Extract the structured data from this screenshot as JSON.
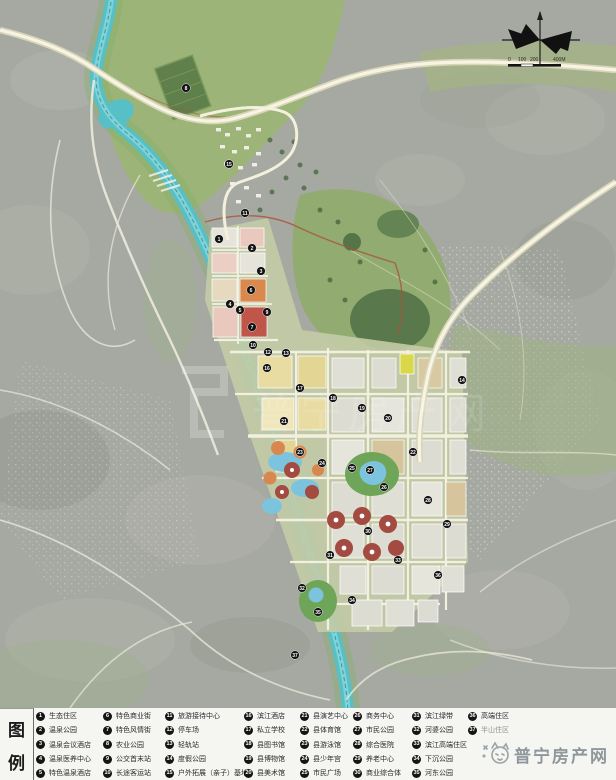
{
  "map": {
    "scale_bar": {
      "labels": [
        "0",
        "100",
        "200",
        "400M"
      ],
      "label_x": [
        0,
        10,
        22,
        45
      ]
    },
    "ghost_watermark": "普宁房产网",
    "colors": {
      "river": "#57bfc6",
      "marker": "#141414",
      "terrain": "#a6a9a1",
      "green": "#96ad74",
      "legend_bg": "#f5f5f2",
      "watermark_gray": "#8e979c"
    },
    "markers": [
      {
        "n": 1,
        "x": 219,
        "y": 239
      },
      {
        "n": 2,
        "x": 252,
        "y": 248
      },
      {
        "n": 3,
        "x": 261,
        "y": 271
      },
      {
        "n": 4,
        "x": 230,
        "y": 304
      },
      {
        "n": 5,
        "x": 240,
        "y": 310
      },
      {
        "n": 6,
        "x": 251,
        "y": 290
      },
      {
        "n": 7,
        "x": 252,
        "y": 327
      },
      {
        "n": 8,
        "x": 186,
        "y": 88
      },
      {
        "n": 9,
        "x": 267,
        "y": 312
      },
      {
        "n": 10,
        "x": 253,
        "y": 345
      },
      {
        "n": 11,
        "x": 245,
        "y": 213
      },
      {
        "n": 12,
        "x": 268,
        "y": 352
      },
      {
        "n": 13,
        "x": 286,
        "y": 353
      },
      {
        "n": 14,
        "x": 462,
        "y": 380
      },
      {
        "n": 15,
        "x": 229,
        "y": 164
      },
      {
        "n": 16,
        "x": 267,
        "y": 368
      },
      {
        "n": 17,
        "x": 300,
        "y": 388
      },
      {
        "n": 18,
        "x": 333,
        "y": 398
      },
      {
        "n": 19,
        "x": 362,
        "y": 408
      },
      {
        "n": 20,
        "x": 388,
        "y": 418
      },
      {
        "n": 21,
        "x": 284,
        "y": 421
      },
      {
        "n": 22,
        "x": 413,
        "y": 452
      },
      {
        "n": 23,
        "x": 300,
        "y": 452
      },
      {
        "n": 24,
        "x": 322,
        "y": 463
      },
      {
        "n": 25,
        "x": 352,
        "y": 468
      },
      {
        "n": 26,
        "x": 384,
        "y": 487
      },
      {
        "n": 27,
        "x": 370,
        "y": 470
      },
      {
        "n": 28,
        "x": 428,
        "y": 500
      },
      {
        "n": 29,
        "x": 447,
        "y": 524
      },
      {
        "n": 30,
        "x": 368,
        "y": 531
      },
      {
        "n": 31,
        "x": 330,
        "y": 555
      },
      {
        "n": 32,
        "x": 302,
        "y": 588
      },
      {
        "n": 33,
        "x": 398,
        "y": 560
      },
      {
        "n": 34,
        "x": 352,
        "y": 600
      },
      {
        "n": 35,
        "x": 318,
        "y": 612
      },
      {
        "n": 36,
        "x": 438,
        "y": 575
      },
      {
        "n": 37,
        "x": 295,
        "y": 655
      }
    ]
  },
  "legend": {
    "title": "图例",
    "title_chars": [
      "图",
      "例"
    ],
    "columns": [
      {
        "items": [
          {
            "n": 1,
            "label": "生态住区"
          },
          {
            "n": 2,
            "label": "温泉公园"
          },
          {
            "n": 3,
            "label": "温泉会议酒店"
          },
          {
            "n": 4,
            "label": "温泉医养中心"
          },
          {
            "n": 5,
            "label": "特色温泉酒店"
          }
        ]
      },
      {
        "items": [
          {
            "n": 6,
            "label": "特色商业街"
          },
          {
            "n": 7,
            "label": "特色风情街"
          },
          {
            "n": 8,
            "label": "农业公园"
          },
          {
            "n": 9,
            "label": "公交首末站"
          },
          {
            "n": 10,
            "label": "长途客运站"
          }
        ]
      },
      {
        "items": [
          {
            "n": 11,
            "label": "旅游接待中心"
          },
          {
            "n": 12,
            "label": "停车场"
          },
          {
            "n": 13,
            "label": "轻轨站"
          },
          {
            "n": 14,
            "label": "度假公园"
          },
          {
            "n": 15,
            "label": "户外拓展（亲子）基地"
          }
        ]
      },
      {
        "items": [
          {
            "n": 16,
            "label": "滨江酒店"
          },
          {
            "n": 17,
            "label": "私立学校"
          },
          {
            "n": 18,
            "label": "县图书馆"
          },
          {
            "n": 19,
            "label": "县博物馆"
          },
          {
            "n": 20,
            "label": "县美术馆"
          }
        ]
      },
      {
        "items": [
          {
            "n": 21,
            "label": "县演艺中心"
          },
          {
            "n": 22,
            "label": "县体育馆"
          },
          {
            "n": 23,
            "label": "县游泳馆"
          },
          {
            "n": 24,
            "label": "县少年宫"
          },
          {
            "n": 25,
            "label": "市民广场"
          }
        ]
      },
      {
        "items": [
          {
            "n": 26,
            "label": "商务中心"
          },
          {
            "n": 27,
            "label": "市民公园"
          },
          {
            "n": 28,
            "label": "综合医院"
          },
          {
            "n": 29,
            "label": "养老中心"
          },
          {
            "n": 30,
            "label": "商业综合体"
          }
        ]
      },
      {
        "items": [
          {
            "n": 31,
            "label": "滨江绿带"
          },
          {
            "n": 32,
            "label": "河婆公园"
          },
          {
            "n": 33,
            "label": "滨江高端住区"
          },
          {
            "n": 34,
            "label": "下沉公园"
          },
          {
            "n": 35,
            "label": "河东公园"
          }
        ]
      },
      {
        "items": [
          {
            "n": 36,
            "label": "高端住区"
          },
          {
            "n": 37,
            "label": "半山住区",
            "faded": true
          }
        ]
      }
    ]
  },
  "watermark": {
    "text": "普宁房产网"
  }
}
